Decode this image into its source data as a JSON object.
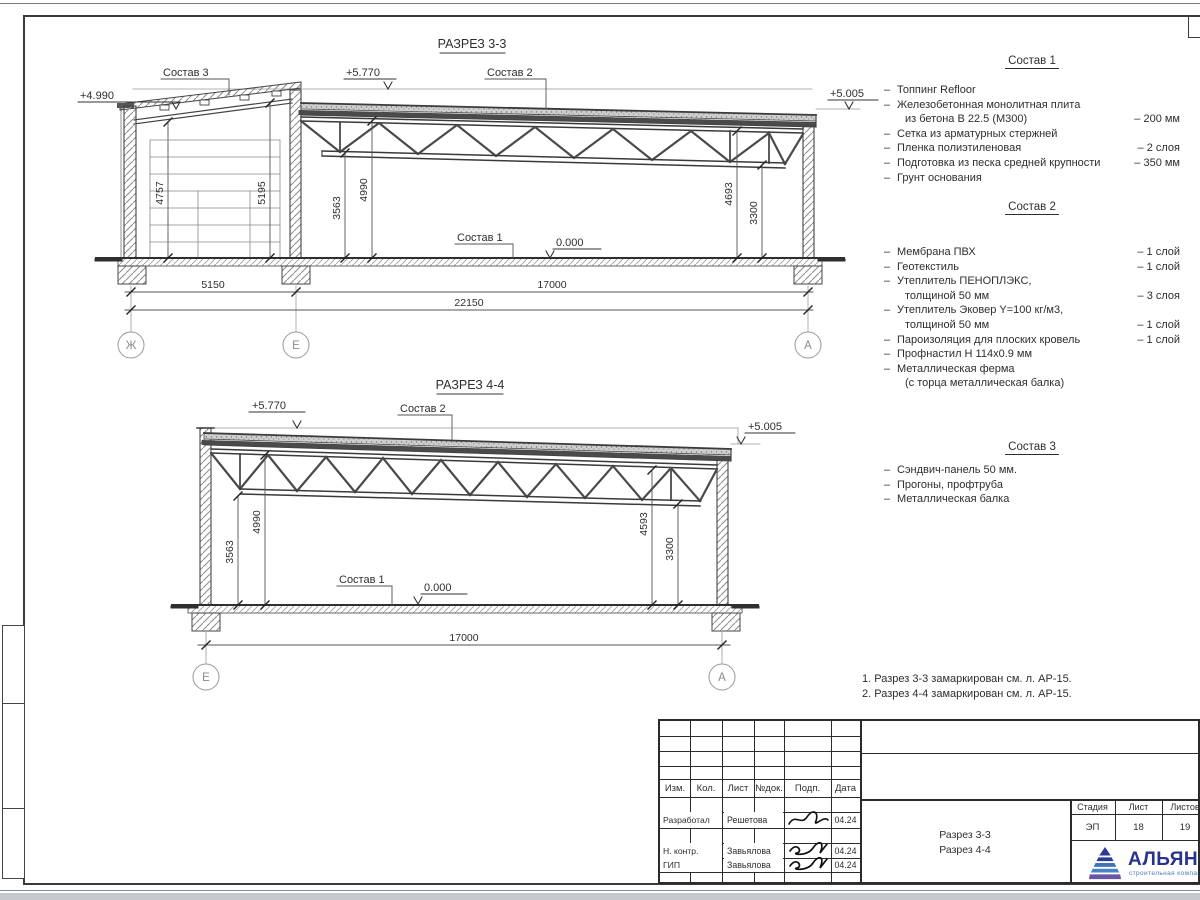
{
  "s33": {
    "title": "РАЗРЕЗ 3-3",
    "sostav1": "Состав 1",
    "sostav2": "Состав 2",
    "sostav3": "Состав 3",
    "e_left": "+4.990",
    "e_top": "+5.770",
    "e_right": "+5.005",
    "e_zero": "0.000",
    "d1": "4757",
    "d2": "5195",
    "d3": "3563",
    "d4": "4990",
    "d5": "4693",
    "d6": "3300",
    "w1": "5150",
    "w2": "17000",
    "w3": "22150",
    "ax1": "Ж",
    "ax2": "Е",
    "ax3": "А"
  },
  "s44": {
    "title": "РАЗРЕЗ 4-4",
    "sostav1": "Состав 1",
    "sostav2": "Состав 2",
    "e_top": "+5.770",
    "e_right": "+5.005",
    "e_zero": "0.000",
    "d1": "3563",
    "d2": "4990",
    "d3": "4593",
    "d4": "3300",
    "w1": "17000",
    "ax1": "Е",
    "ax2": "А"
  },
  "comp1": {
    "title": "Состав 1",
    "rows": [
      {
        "b": "–",
        "t": "Топпинг Refloor",
        "v": ""
      },
      {
        "b": "–",
        "t": "Железобетонная  монолитная плита",
        "v": ""
      },
      {
        "b": "",
        "t": "из бетона В 22.5 (М300)",
        "v": "– 200 мм"
      },
      {
        "b": "–",
        "t": "Сетка из арматурных стержней",
        "v": ""
      },
      {
        "b": "–",
        "t": "Пленка полиэтиленовая",
        "v": "– 2 слоя"
      },
      {
        "b": "–",
        "t": "Подготовка из песка средней крупности",
        "v": "– 350 мм"
      },
      {
        "b": "–",
        "t": "Грунт основания",
        "v": ""
      }
    ]
  },
  "comp2": {
    "title": "Состав 2",
    "rows": [
      {
        "b": "–",
        "t": "Мембрана ПВХ",
        "v": "– 1 слой"
      },
      {
        "b": "–",
        "t": "Геотекстиль",
        "v": "– 1 слой"
      },
      {
        "b": "–",
        "t": "Утеплитель ПЕНОПЛЭКС,",
        "v": ""
      },
      {
        "b": "",
        "t": "толщиной 50 мм",
        "v": "– 3 слоя"
      },
      {
        "b": "–",
        "t": "Утеплитель Эковер Y=100 кг/м3,",
        "v": ""
      },
      {
        "b": "",
        "t": "толщиной 50 мм",
        "v": "– 1 слой"
      },
      {
        "b": "–",
        "t": "Пароизоляция для плоских кровель",
        "v": "– 1 слой"
      },
      {
        "b": "–",
        "t": "Профнастил Н 114х0.9 мм",
        "v": ""
      },
      {
        "b": "–",
        "t": "Металлическая ферма",
        "v": ""
      },
      {
        "b": "",
        "t": "(с торца металлическая балка)",
        "v": ""
      }
    ]
  },
  "comp3": {
    "title": "Состав 3",
    "rows": [
      {
        "b": "–",
        "t": "Сэндвич-панель 50 мм.",
        "v": ""
      },
      {
        "b": "–",
        "t": "Прогоны, профтруба",
        "v": ""
      },
      {
        "b": "–",
        "t": "Металлическая балка",
        "v": ""
      }
    ]
  },
  "notes": {
    "n1": "1. Разрез 3-3 замаркирован см. л. АР-15.",
    "n2": "2. Разрез 4-4 замаркирован см. л. АР-15."
  },
  "tb": {
    "h_izm": "Изм.",
    "h_kol": "Кол.",
    "h_list": "Лист",
    "h_ndok": "№док.",
    "h_podp": "Подп.",
    "h_data": "Дата",
    "r1_role": "Разработал",
    "r1_name": "Решетова",
    "r1_date": "04.24",
    "r2_role": "Н. контр.",
    "r2_name": "Завьялова",
    "r2_date": "04.24",
    "r3_role": "ГИП",
    "r3_name": "Завьялова",
    "r3_date": "04.24",
    "doc1": "Разрез 3-3",
    "doc2": "Разрез 4-4",
    "stage_h": "Стадия",
    "list_h": "Лист",
    "listov_h": "Листов",
    "stage": "ЭП",
    "list": "18",
    "listov": "19",
    "brand": "АЛЬЯНС",
    "brand_sub": "строительная компания"
  },
  "colors": {
    "brand_navy": "#27338e",
    "brand_blue": "#4a7bbd",
    "line": "#3a3a3a"
  }
}
